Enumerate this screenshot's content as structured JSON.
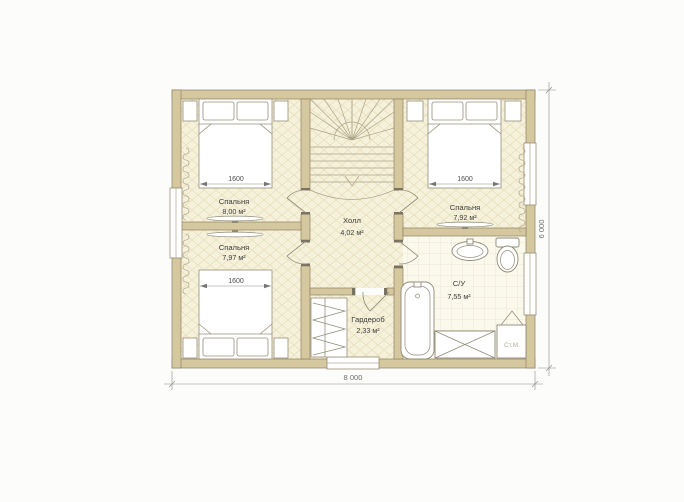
{
  "plan": {
    "rooms": {
      "bedroom_top_left": {
        "name": "Спальня",
        "area": "8,00 м²",
        "bed_width": "1600"
      },
      "bedroom_bottom_left": {
        "name": "Спальня",
        "area": "7,97 м²",
        "bed_width": "1600"
      },
      "bedroom_top_right": {
        "name": "Спальня",
        "area": "7,92 м²",
        "bed_width": "1600"
      },
      "hall": {
        "name": "Холл",
        "area": "4,02 м²"
      },
      "wardrobe": {
        "name": "Гардероб",
        "area": "2,33 м²"
      },
      "bathroom": {
        "name": "С/У",
        "area": "7,55 м²"
      }
    },
    "overall_dimensions": {
      "width": "8 000",
      "height": "6 000"
    },
    "appliances": {
      "washing_machine": "Ст.М."
    },
    "colors": {
      "wall": "#d6c89e",
      "wall_outline": "#8d8164",
      "parquet_floor": "#f6f1da",
      "parquet_line": "#e7ddbb",
      "tile_floor": "#fbf8ec",
      "tile_line": "#e9e3cd",
      "label_text": "#3d3d3d",
      "dim_text": "#6e6e6e",
      "background": "#fcfcfb"
    }
  }
}
